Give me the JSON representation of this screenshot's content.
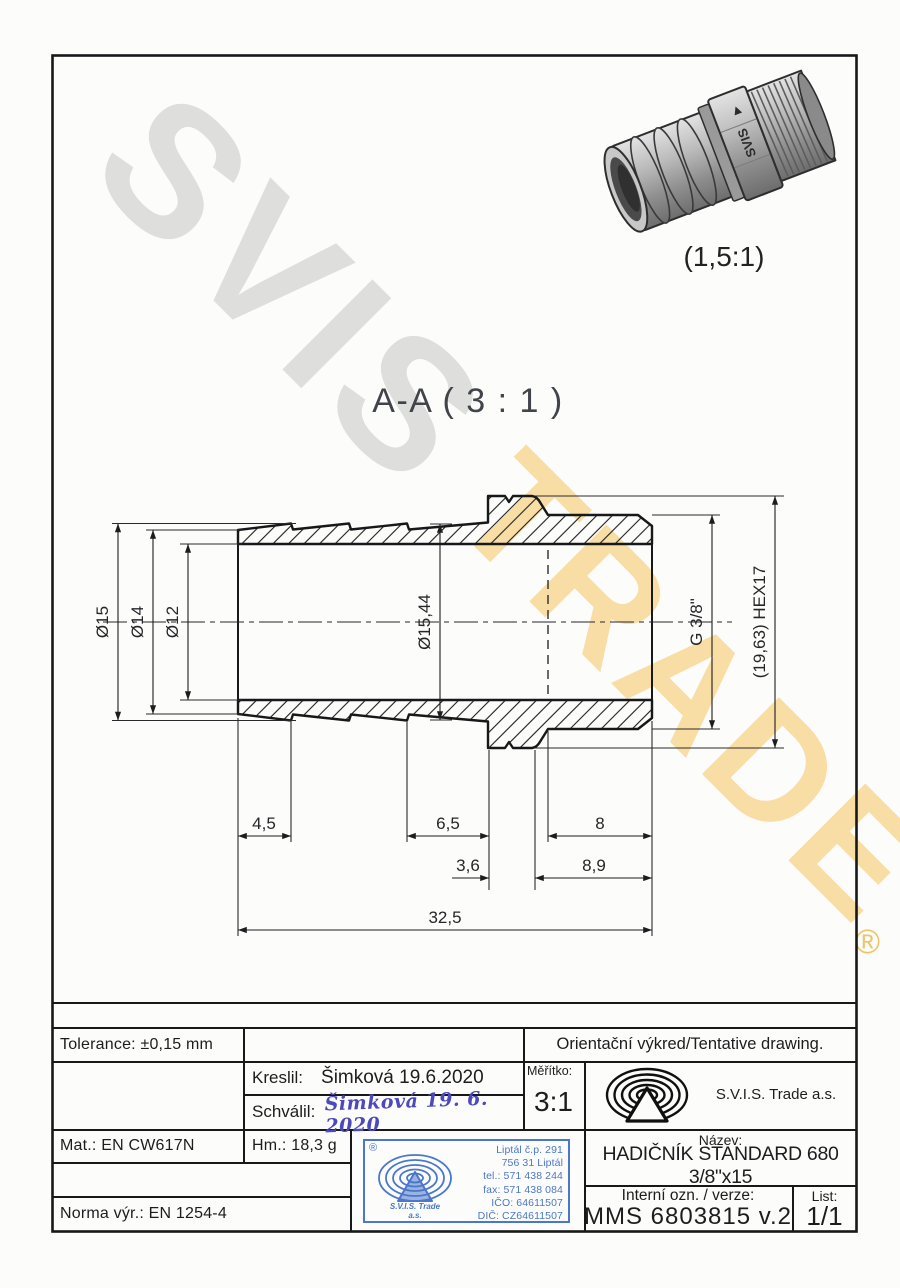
{
  "watermark": {
    "word1": "SVIS",
    "word2": "TRADE",
    "registered": "®"
  },
  "pictorial": {
    "scale_label": "(1,5:1)",
    "engraving": "SVIS"
  },
  "section_view": {
    "title": "A-A ( 3 : 1 )"
  },
  "dimensions": {
    "d15": "Ø15",
    "d14": "Ø14",
    "d12": "Ø12",
    "d1544": "Ø15,44",
    "thread": "G 3/8\"",
    "hex": "(19,63) HEX17",
    "l45": "4,5",
    "l65": "6,5",
    "l8": "8",
    "l36": "3,6",
    "l89": "8,9",
    "l325": "32,5"
  },
  "title_block": {
    "tolerance": "Tolerance: ±0,15 mm",
    "orientation_note": "Orientační výkred/Tentative drawing.",
    "kreslil_label": "Kreslil:",
    "kreslil_value": "Šimková 19.6.2020",
    "schvalil_label": "Schválil:",
    "schvalil_signature": "Šimková 19. 6. 2020",
    "meritko_label": "Měřítko:",
    "meritko_value": "3:1",
    "company": "S.V.I.S. Trade a.s.",
    "mat": "Mat.: EN CW617N",
    "hm": "Hm.: 18,3 g",
    "norma": "Norma výr.: EN 1254-4",
    "nazev_label": "Název:",
    "nazev_value": "HADIČNÍK STANDARD 680 3/8\"x15",
    "interni_label": "Interní ozn. / verze:",
    "interni_value": "MMS 6803815 v.2",
    "list_label": "List:",
    "list_value": "1/1"
  },
  "stamp": {
    "registered": "®",
    "company_line1": "S.V.I.S. Trade",
    "company_line2": "a.s.",
    "lines": [
      "Liptál č.p. 291",
      "756 31 Liptál",
      "tel.: 571 438 244",
      "fax: 571 438 084",
      "IČO: 64611507",
      "DIČ: CZ64611507"
    ]
  },
  "colors": {
    "stamp_blue": "#4a77cb",
    "watermark_yellow": "#f4c45c",
    "line": "#17181a"
  }
}
